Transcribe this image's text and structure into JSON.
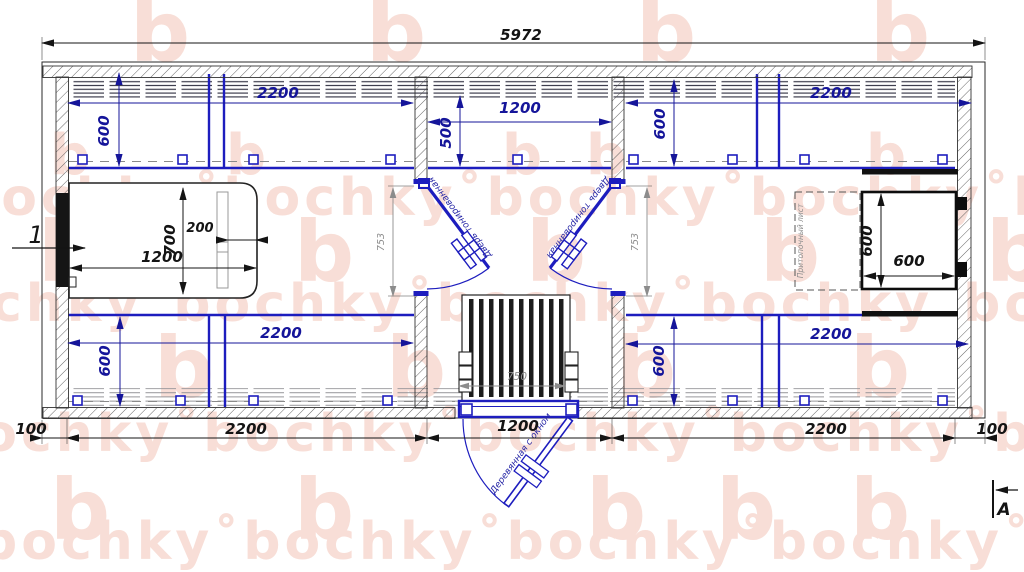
{
  "plan": {
    "dims": {
      "overall": "5972",
      "top_left_width": "2200",
      "top_left_depth": "600",
      "mid_width": "1200",
      "mid_depth": "500",
      "top_right_width": "2200",
      "top_right_depth": "600",
      "bottom_left_width": "2200",
      "bottom_left_depth": "600",
      "bottom_right_width": "2200",
      "bottom_right_depth": "600",
      "bed_length": "1200",
      "bed_width": "700",
      "bed_shelf": "200",
      "stove_width": "600",
      "stove_depth": "600",
      "door_opening_left": "753",
      "door_opening_right": "753",
      "grate_width": "750",
      "bottom_100_left": "100",
      "bottom_2200_left": "2200",
      "bottom_1200": "1200",
      "bottom_2200_right": "2200",
      "bottom_100_right": "100"
    },
    "labels": {
      "door_tinted": "Дверь тонированная",
      "door_entrance": "Деревянная с окном",
      "stove_sheet": "Притопочный лист"
    },
    "markers": {
      "view_number": "1",
      "section_letter": "А"
    }
  },
  "watermark": {
    "word": "bochky",
    "logo": "b",
    "separator": "˚"
  },
  "colors": {
    "line_blue": "#1d1dbe",
    "dim_blue": "#15159a",
    "line_black": "#141414",
    "dim_gray": "#8c8c8c",
    "watermark_pink": "#f8ded7",
    "paper": "#ffffff"
  }
}
